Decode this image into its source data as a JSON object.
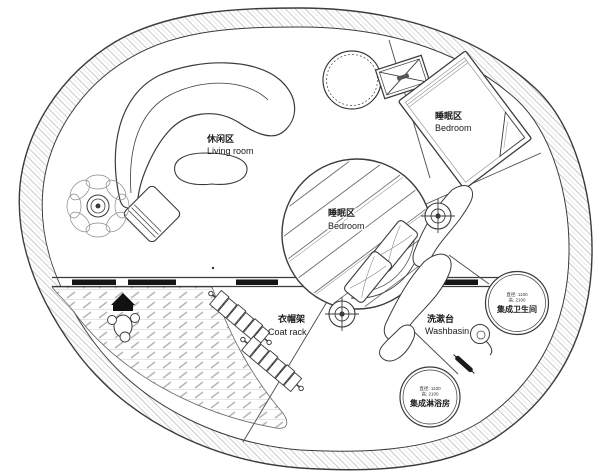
{
  "colors": {
    "line": "#3b3b3b",
    "ring_hatch": "#c9c9c9",
    "deck_hatch": "#b8b8b8",
    "black_fill": "#151515",
    "text": "#1a1a1a",
    "background": "#ffffff"
  },
  "areas": {
    "living_room": {
      "label_cn": "休闲区",
      "label_en": "Living room"
    },
    "bedroom_upper": {
      "label_cn": "睡眠区",
      "label_en": "Bedroom"
    },
    "bedroom_center": {
      "label_cn": "睡眠区",
      "label_en": "Bedroom"
    },
    "coat_rack": {
      "label_cn": "衣帽架",
      "label_en": "Coat rack"
    },
    "washbasin": {
      "label_cn": "洗漱台",
      "label_en": "Washbasin"
    },
    "bathroom_pod": {
      "name_cn": "集成卫生间",
      "dims": [
        "直径: 1100",
        "高: 2100"
      ]
    },
    "shower_pod": {
      "name_cn": "集成淋浴房",
      "dims": [
        "直径: 1100",
        "高: 2100"
      ]
    }
  }
}
